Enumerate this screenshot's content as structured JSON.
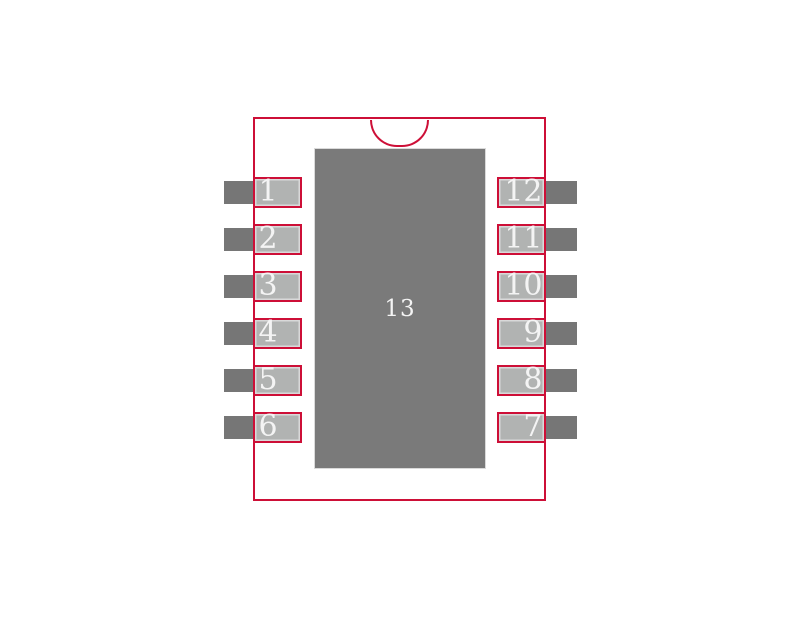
{
  "diagram": {
    "title": "ic-package-footprint-land-pattern",
    "package": {
      "pin_count_label": "13",
      "pin1_indicator": "semicircle-notch-top-center"
    },
    "center_pad": {
      "number": "13"
    },
    "left_pins": [
      "1",
      "2",
      "3",
      "4",
      "5",
      "6"
    ],
    "right_pins": [
      "12",
      "11",
      "10",
      "9",
      "8",
      "7"
    ],
    "colors": {
      "background": "#ffffff",
      "outline_red": "#cd0f37",
      "pad_fill_gray": "#b1b3b2",
      "pad_inner_ring": "#d9d9d9",
      "lead_gray": "#767676",
      "thermal_pad_gray": "#7a7a7a",
      "number_text": "#f4f4f4"
    }
  }
}
